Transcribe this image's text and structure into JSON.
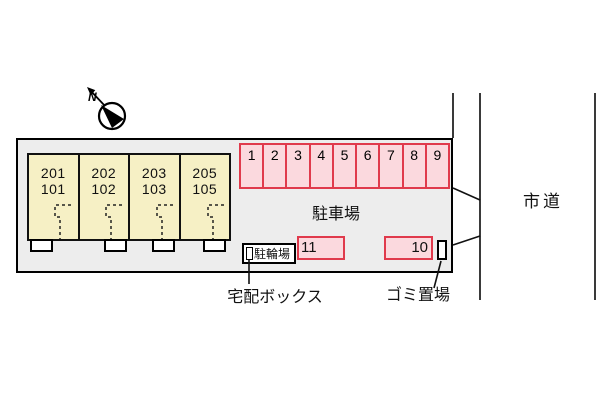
{
  "compass": {
    "north_label": "N"
  },
  "building": {
    "units": [
      {
        "upper": "201",
        "lower": "101"
      },
      {
        "upper": "202",
        "lower": "102"
      },
      {
        "upper": "203",
        "lower": "103"
      },
      {
        "upper": "205",
        "lower": "105"
      }
    ]
  },
  "parking": {
    "area_label": "駐車場",
    "row_spaces": [
      "1",
      "2",
      "3",
      "4",
      "5",
      "6",
      "7",
      "8",
      "9"
    ],
    "space_11": "11",
    "space_10": "10"
  },
  "bicycle": {
    "label": "駐輪場"
  },
  "annotations": {
    "delivery_box": "宅配ボックス",
    "garbage_area": "ゴミ置場",
    "city_road": "市道"
  },
  "colors": {
    "site_fill": "#ededed",
    "building_fill": "#f6f0c5",
    "parking_fill": "#fbd9de",
    "parking_border": "#e03a4c",
    "line": "#000000"
  }
}
